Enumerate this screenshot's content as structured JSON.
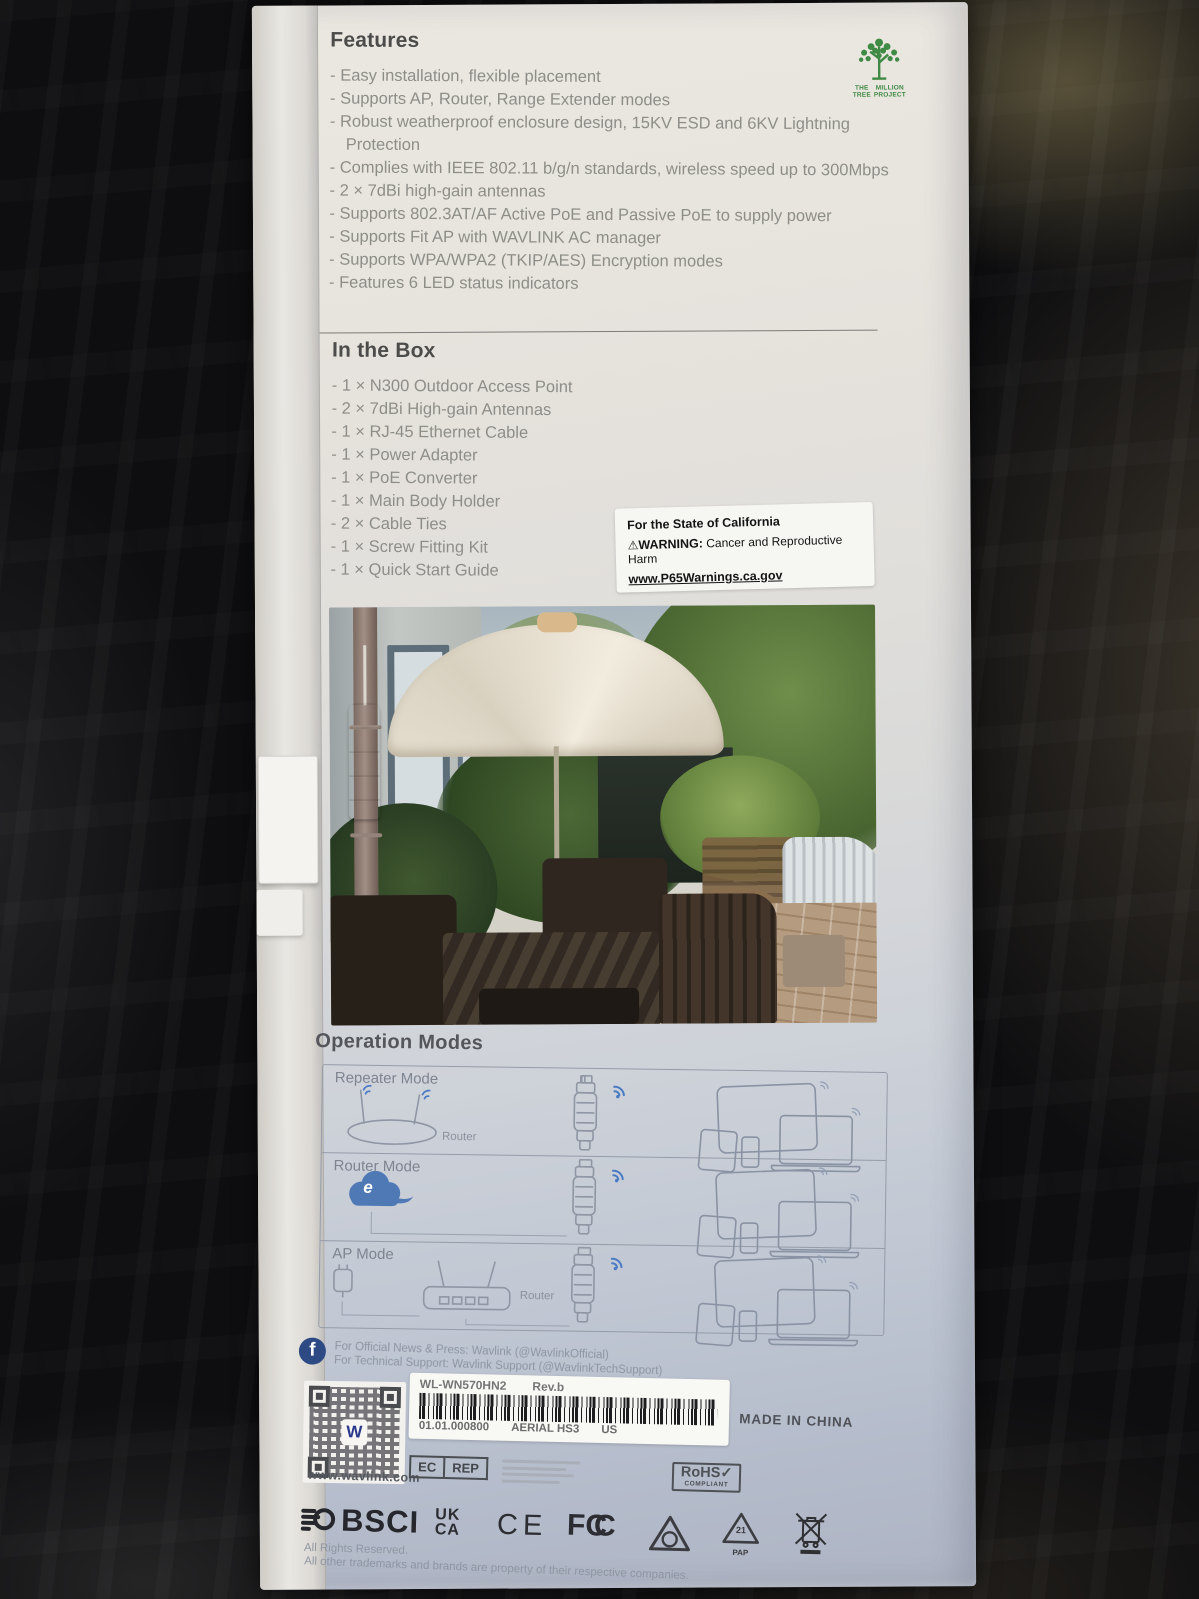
{
  "colors": {
    "tree_green": "#3f8a44",
    "wifi_blue": "#4a7bc4",
    "facebook_blue": "#2d4a85",
    "qr_w_blue": "#2b3a8c",
    "box_paper": "#e7e3dd"
  },
  "features": {
    "heading": "Features",
    "items": [
      "- Easy installation, flexible placement",
      "- Supports AP, Router, Range Extender modes",
      "- Robust weatherproof enclosure design, 15KV ESD and 6KV Lightning Protection",
      "- Complies with IEEE 802.11 b/g/n standards, wireless speed up to 300Mbps",
      "- 2 × 7dBi high-gain antennas",
      "- Supports 802.3AT/AF Active PoE and Passive PoE to supply power",
      "- Supports Fit AP with WAVLINK AC manager",
      "- Supports WPA/WPA2 (TKIP/AES) Encryption modes",
      "- Features 6 LED status indicators"
    ]
  },
  "tree": {
    "word1": "THE",
    "word2": "MILLION",
    "word3": "TREE",
    "word4": "PROJECT"
  },
  "in_box": {
    "heading": "In the Box",
    "items": [
      "- 1 × N300 Outdoor Access Point",
      "- 2 × 7dBi High-gain Antennas",
      "- 1 × RJ-45 Ethernet Cable",
      "- 1 × Power Adapter",
      "- 1 × PoE Converter",
      "- 1 × Main Body Holder",
      "- 2 × Cable Ties",
      "- 1 × Screw Fitting Kit",
      "- 1 × Quick Start Guide"
    ]
  },
  "warning": {
    "line1": "For the State of California",
    "icon": "⚠",
    "bold": "WARNING:",
    "rest": " Cancer and Reproductive Harm",
    "url": "www.P65Warnings.ca.gov"
  },
  "modes": {
    "heading": "Operation Modes",
    "router_label": "Router",
    "cloud_letter": "e",
    "rows": [
      {
        "label": "Repeater Mode"
      },
      {
        "label": "Router Mode"
      },
      {
        "label": "AP Mode"
      }
    ]
  },
  "social": {
    "fb": "f",
    "line1": "For Official News & Press: Wavlink (@WavlinkOfficial)",
    "line2": "For Technical Support: Wavlink Support (@WavlinkTechSupport)"
  },
  "qr": {
    "letter": "W"
  },
  "website": "www.wavlink.com",
  "sticker": {
    "model": "WL-WN570HN2",
    "rev": "Rev.b",
    "code": "01.01.000800",
    "name": "AERIAL HS3",
    "region": "US"
  },
  "made_in": "MADE IN CHINA",
  "badges": {
    "ec": "EC",
    "rep": "REP",
    "rohs": "RoHS✓",
    "rohs_sub": "COMPLIANT",
    "bsci": "BSCI",
    "uk": "UK",
    "ca": "CA",
    "ce": "CE",
    "fcc_f": "F",
    "fcc_c": "C",
    "pap_num": "21",
    "pap_label": "PAP"
  },
  "footer": {
    "rights": "All Rights Reserved.",
    "note": "All other trademarks and brands are property of their respective companies."
  }
}
